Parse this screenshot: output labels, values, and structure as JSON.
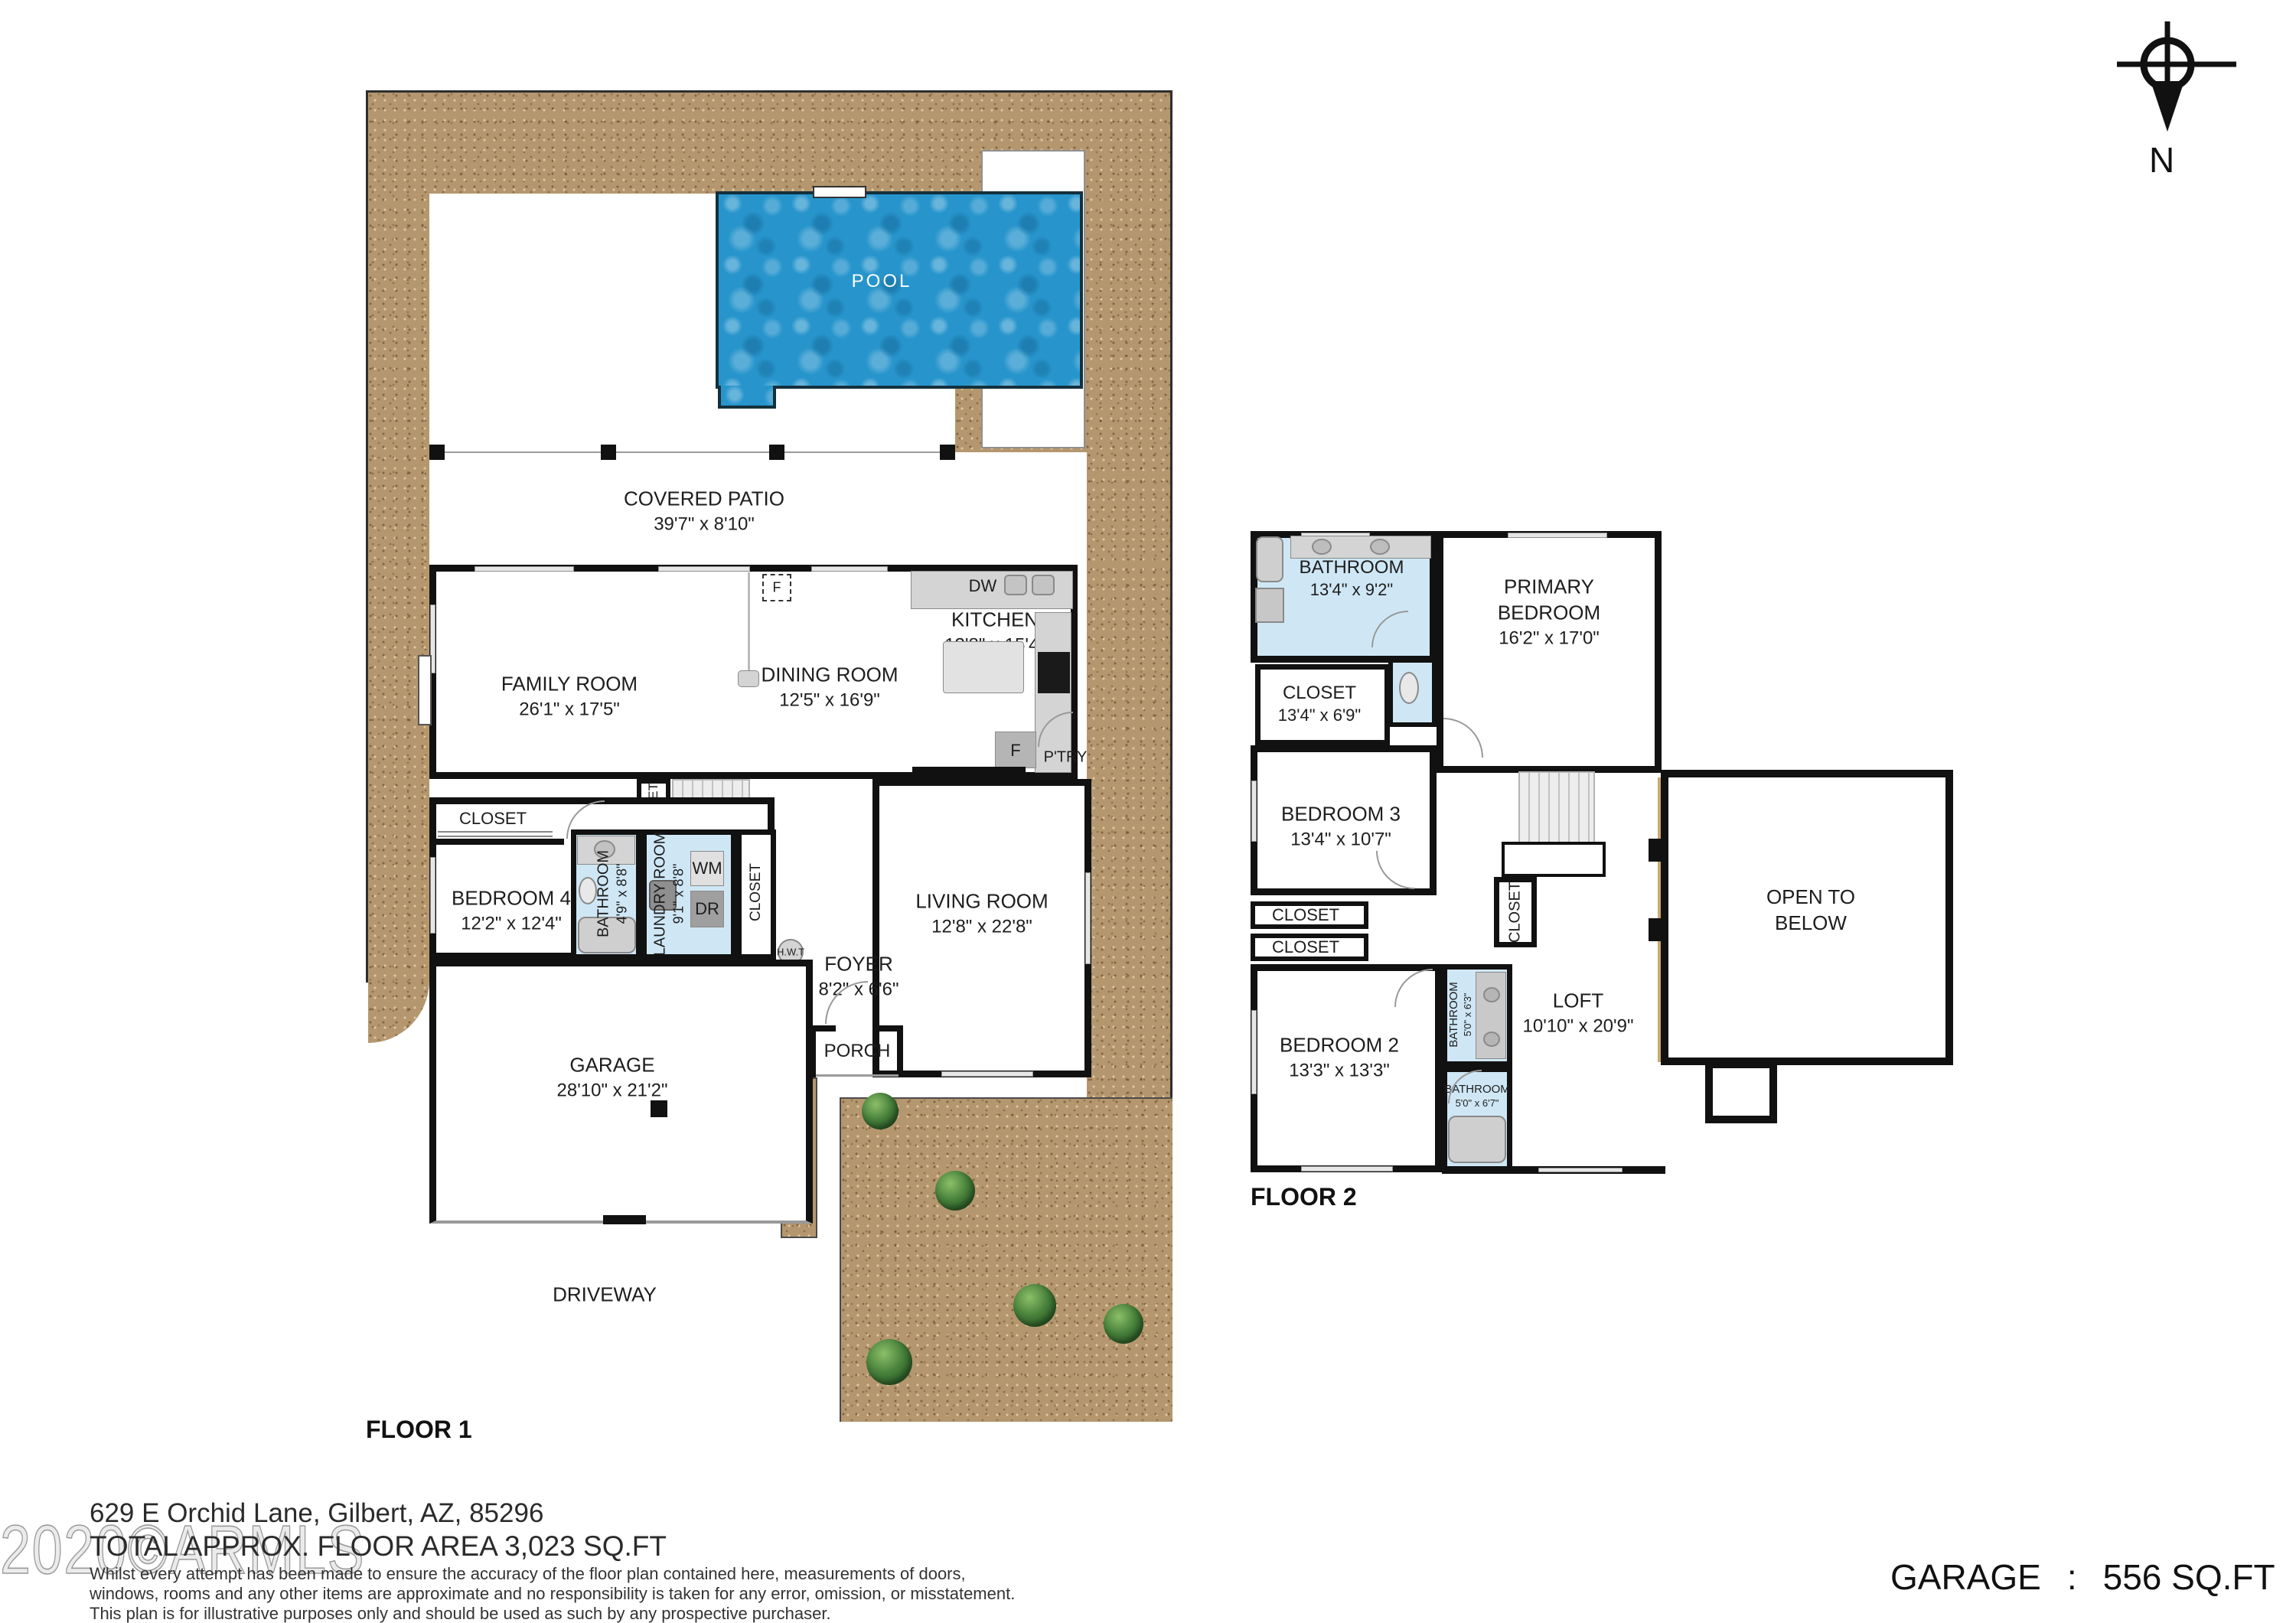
{
  "meta": {
    "floor1_label": "FLOOR 1",
    "floor2_label": "FLOOR 2",
    "compass_label": "N"
  },
  "floor1": {
    "pool": {
      "name": "POOL"
    },
    "covered_patio": {
      "name": "COVERED PATIO",
      "dims": "39'7\" x 8'10\""
    },
    "family_room": {
      "name": "FAMILY ROOM",
      "dims": "26'1\" x 17'5\""
    },
    "dining_room": {
      "name": "DINING ROOM",
      "dims": "12'5\" x 16'9\""
    },
    "kitchen": {
      "name": "KITCHEN",
      "dims": "12'8\" x 15'4\""
    },
    "dishwasher": "DW",
    "fridge": "F",
    "pantry": "P'TRY",
    "fireplace": "F",
    "closet_family": "CLOSET",
    "closet_hall": "CLOSET",
    "closet_bed4": "CLOSET",
    "bedroom4": {
      "name": "BEDROOM 4",
      "dims": "12'2\" x 12'4\""
    },
    "bathroom": {
      "name": "BATHROOM",
      "dims": "4'9\" x 8'8\""
    },
    "laundry": {
      "name": "LAUNDRY ROOM",
      "dims": "9'1\" x 8'8\""
    },
    "washer": "WM",
    "dryer": "DR",
    "water_heater": "H.W.T",
    "furnace": "F",
    "living_room": {
      "name": "LIVING ROOM",
      "dims": "12'8\" x 22'8\""
    },
    "foyer": {
      "name": "FOYER",
      "dims": "8'2\" x 6'6\""
    },
    "porch": {
      "name": "PORCH"
    },
    "garage": {
      "name": "GARAGE",
      "dims": "28'10\" x 21'2\""
    },
    "driveway": {
      "name": "DRIVEWAY"
    }
  },
  "floor2": {
    "bathroom_primary": {
      "name": "BATHROOM",
      "dims": "13'4\" x 9'2\""
    },
    "primary_bedroom": {
      "line1": "PRIMARY",
      "line2": "BEDROOM",
      "dims": "16'2\" x 17'0\""
    },
    "closet_primary": {
      "name": "CLOSET",
      "dims": "13'4\" x 6'9\""
    },
    "bedroom3": {
      "name": "BEDROOM 3",
      "dims": "13'4\" x 10'7\""
    },
    "closet_a": "CLOSET",
    "closet_b": "CLOSET",
    "closet_stairs": "CLOSET",
    "bedroom2": {
      "name": "BEDROOM 2",
      "dims": "13'3\" x 13'3\""
    },
    "bathroom_hall": {
      "name": "BATHROOM",
      "dims": "5'0\" x 6'3\""
    },
    "bathroom_tub": {
      "name": "BATHROOM",
      "dims": "5'0\" x 6'7\""
    },
    "loft": {
      "name": "LOFT",
      "dims": "10'10\" x 20'9\""
    },
    "open_to_below": {
      "line1": "OPEN TO",
      "line2": "BELOW"
    }
  },
  "footer": {
    "address": "629 E Orchid Lane, Gilbert, AZ, 85296",
    "total_area": "TOTAL APPROX. FLOOR AREA 3,023 SQ.FT",
    "disclaimer_line1": "Whilst every attempt has been made to ensure the accuracy of the floor plan contained here, measurements of doors,",
    "disclaimer_line2": "windows, rooms and any other items are approximate and no responsibility is taken for any error, omission, or misstatement.",
    "disclaimer_line3": "This plan is for illustrative purposes only and should be used as such by any prospective purchaser.",
    "garage_label": "GARAGE",
    "garage_sep": ":",
    "garage_value": "556 SQ.FT",
    "watermark": "2020©ARMLS"
  },
  "colors": {
    "pool_blue": "#2795cc",
    "bathroom_blue": "#cfe7f5",
    "dirt_tan": "#b5976f",
    "wall_black": "#111111",
    "railing_tan": "#c9a873",
    "shrub_green": "#49823c"
  }
}
